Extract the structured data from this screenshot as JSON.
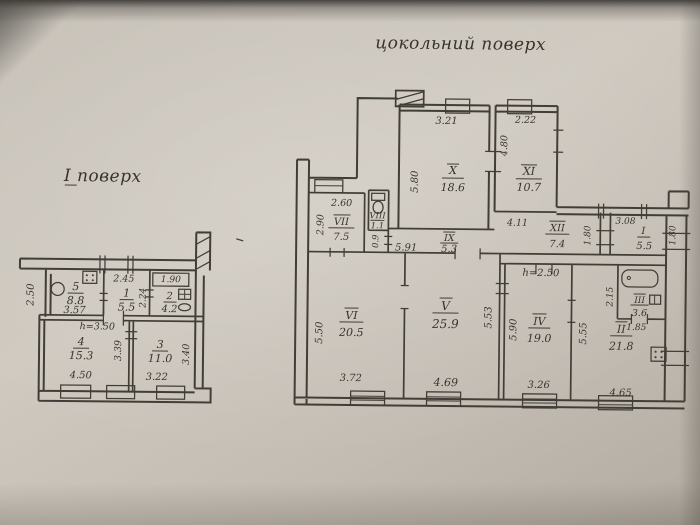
{
  "colors": {
    "paper": "#cbc5bc",
    "ink": "#413d37"
  },
  "plans": {
    "first_floor": {
      "title": "I поверх",
      "note": "h=3.50",
      "rooms": {
        "r5": {
          "num": "5",
          "area": "8.8",
          "w": "3.57",
          "d": "2.50"
        },
        "r1": {
          "num": "1",
          "area": "5.5",
          "w": "2.45",
          "d": "2.24"
        },
        "r2": {
          "num": "2",
          "area": "4.2",
          "w": "1.90"
        },
        "r4": {
          "num": "4",
          "area": "15.3",
          "w": "4.50",
          "d": "3.39"
        },
        "r3": {
          "num": "3",
          "area": "11.0",
          "w": "3.22",
          "d": "3.40"
        }
      }
    },
    "basement": {
      "title": "цокольний поверх",
      "rooms": {
        "x": {
          "num": "X",
          "area": "18.6",
          "w": "3.21",
          "d": "5.80"
        },
        "xi": {
          "num": "XI",
          "area": "10.7",
          "w": "2.22",
          "d": "4.80"
        },
        "vii": {
          "num": "VII",
          "area": "7.5",
          "w": "2.60",
          "d": "2.90"
        },
        "viii": {
          "num": "VIII",
          "area": "1.1"
        },
        "ix": {
          "num": "IX",
          "area": "5.3",
          "w": "5.91",
          "door": "0.9"
        },
        "xii": {
          "num": "XII",
          "area": "7.4",
          "w": "4.11",
          "d": "1.80"
        },
        "i": {
          "num": "I",
          "area": "5.5",
          "w": "3.08",
          "d": "1.80"
        },
        "vi": {
          "num": "VI",
          "area": "20.5",
          "w": "3.72",
          "d": "5.50"
        },
        "v": {
          "num": "V",
          "area": "25.9",
          "w": "4.69",
          "d": "5.53"
        },
        "iv": {
          "num": "IV",
          "area": "19.0",
          "w": "3.26",
          "d": "5.90",
          "note": "h=2.50"
        },
        "ii": {
          "num": "II",
          "area": "21.8",
          "w": "4.65",
          "d": "5.55"
        },
        "iii": {
          "num": "III",
          "area": "3.6",
          "w": "1.85",
          "d": "2.15"
        }
      }
    }
  }
}
